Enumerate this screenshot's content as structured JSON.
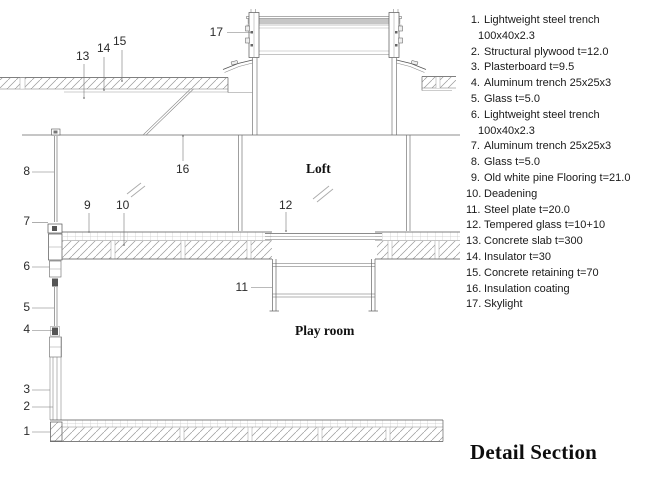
{
  "title": "Detail Section",
  "drawing": {
    "room_labels": {
      "loft": "Loft",
      "play_room": "Play room"
    },
    "callouts": [
      "1",
      "2",
      "3",
      "4",
      "5",
      "6",
      "7",
      "8",
      "9",
      "10",
      "11",
      "12",
      "13",
      "14",
      "15",
      "16",
      "17"
    ]
  },
  "legend": {
    "items": [
      {
        "num": "1.",
        "text": "Lightweight steel trench",
        "text2": "100x40x2.3"
      },
      {
        "num": "2.",
        "text": "Structural plywood t=12.0"
      },
      {
        "num": "3.",
        "text": "Plasterboard t=9.5"
      },
      {
        "num": "4.",
        "text": "Aluminum trench 25x25x3"
      },
      {
        "num": "5.",
        "text": "Glass t=5.0"
      },
      {
        "num": "6.",
        "text": "Lightweight steel trench",
        "text2": "100x40x2.3"
      },
      {
        "num": "7.",
        "text": "Aluminum trench 25x25x3"
      },
      {
        "num": "8.",
        "text": "Glass t=5.0"
      },
      {
        "num": "9.",
        "text": "Old white pine Flooring t=21.0"
      },
      {
        "num": "10.",
        "text": "Deadening"
      },
      {
        "num": "11.",
        "text": "Steel plate t=20.0"
      },
      {
        "num": "12.",
        "text": "Tempered glass t=10+10"
      },
      {
        "num": "13.",
        "text": "Concrete slab t=300"
      },
      {
        "num": "14.",
        "text": "Insulator t=30"
      },
      {
        "num": "15.",
        "text": "Concrete retaining t=70"
      },
      {
        "num": "16.",
        "text": "Insulation coating"
      },
      {
        "num": "17.",
        "text": "Skylight"
      }
    ]
  },
  "colors": {
    "line": "#555555",
    "light_line": "#999999",
    "glass_fill": "#c6c6c6",
    "hatch": "#9a9a9a",
    "text": "#1a1a1a"
  }
}
